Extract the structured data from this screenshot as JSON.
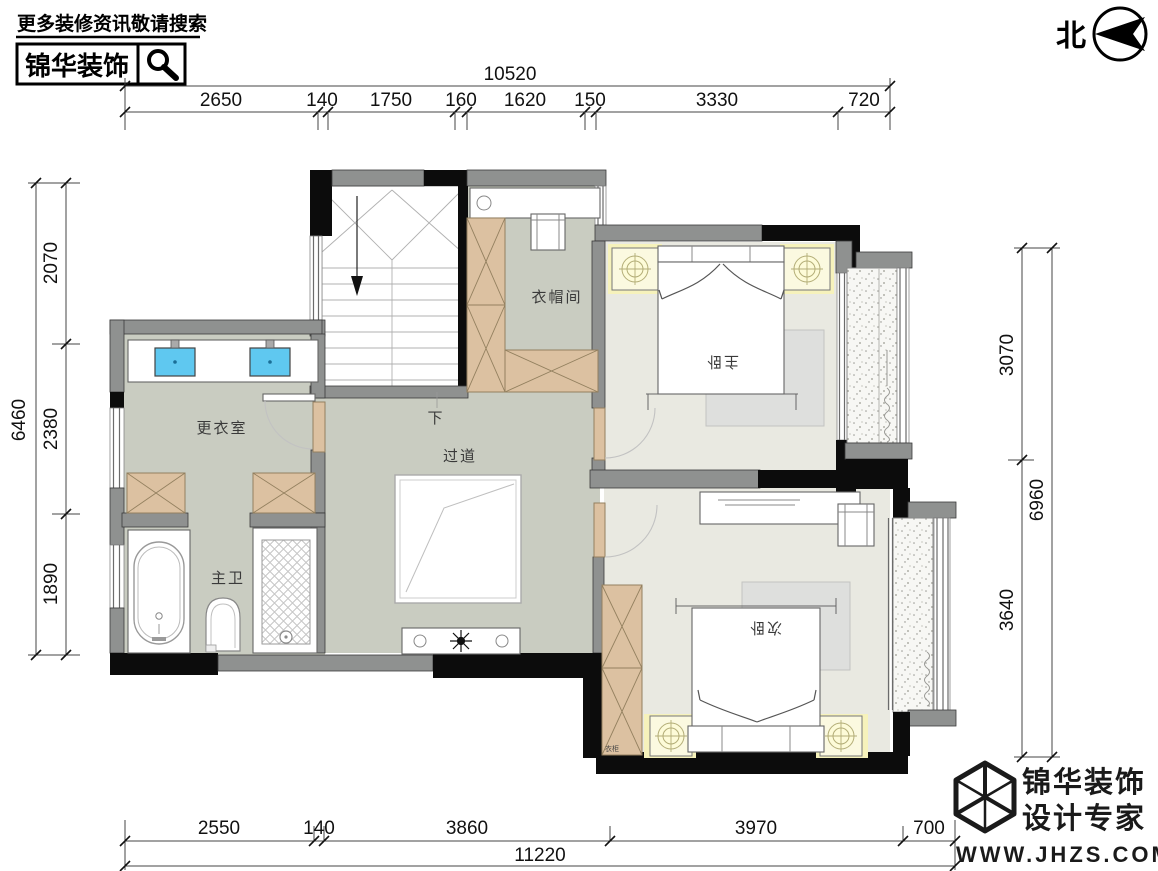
{
  "header": {
    "search_hint": "更多装修资讯敬请搜索",
    "brand": "锦华装饰",
    "search_icon": "magnifier-icon"
  },
  "north": {
    "label": "北"
  },
  "dims": {
    "top": {
      "total": "10520",
      "segs": [
        "2650",
        "140",
        "1750",
        "160",
        "1620",
        "150",
        "3330",
        "720"
      ]
    },
    "left": {
      "total": "6460",
      "segs": [
        "2070",
        "2380",
        "1890"
      ]
    },
    "right": {
      "total": "6960",
      "segs": [
        "3070",
        "3640"
      ]
    },
    "bottom": {
      "total": "11220",
      "segs": [
        "2550",
        "140",
        "3860",
        "3970",
        "700"
      ]
    }
  },
  "rooms": {
    "cloakroom": "衣帽间",
    "master_bedroom": "主卧",
    "dressing_room": "更衣室",
    "master_bath": "主卫",
    "corridor": "过道",
    "stairs_down": "下",
    "second_bedroom": "次卧",
    "wardrobe_tag": "衣柜"
  },
  "footer": {
    "brand": "锦华装饰",
    "tagline": "设计专家",
    "site": "WWW.JHZS.COM"
  },
  "colors": {
    "wall_gray": "#8f9190",
    "wall_black": "#0c0c0c",
    "floor_green": "#c9ccc1",
    "floor_beige": "#e9e9e1",
    "cabinet_tan": "#dcc1a1",
    "sink_blue": "#5fc8f0",
    "light_yellow": "#f6f2bb",
    "rug_gray": "#dedfdd"
  }
}
